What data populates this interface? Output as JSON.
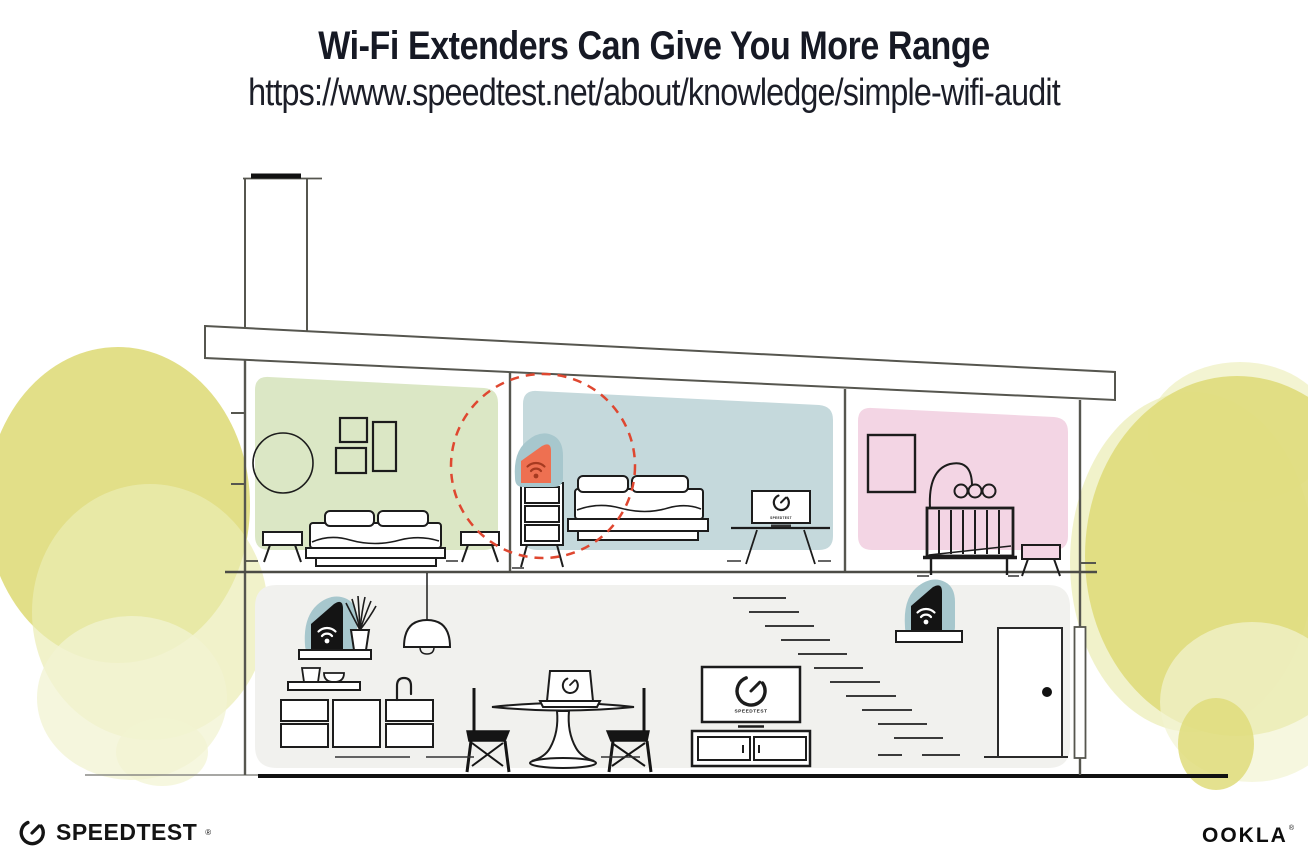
{
  "header": {
    "title": "Wi-Fi Extenders Can Give You More Range",
    "url": "https://www.speedtest.net/about/knowledge/simple-wifi-audit"
  },
  "illustration": {
    "tv_screen_label": "SPEEDTEST",
    "upstairs_tv_label": "SPEEDTEST",
    "colors": {
      "room_green": "#dbe7c5",
      "room_blue": "#c5d9dc",
      "room_pink": "#f3d5e4",
      "lower_floor": "#f1f1ee",
      "device_teal": "#a7c7cd",
      "device_dark": "#141414",
      "extender_orange": "#ee7051",
      "wifi_signal_red": "#a63a20",
      "wifi_signal_white": "#ffffff",
      "coverage_dash_red": "#df4730",
      "tree_yellow": "#dfdc7b",
      "tree_yellow_light": "#ebecb4",
      "tree_yellow_pale": "#f2f3d1"
    }
  },
  "footer": {
    "speedtest_wordmark": "SPEEDTEST",
    "speedtest_reg": "®",
    "ookla_wordmark": "OOKLA",
    "ookla_reg": "®"
  }
}
